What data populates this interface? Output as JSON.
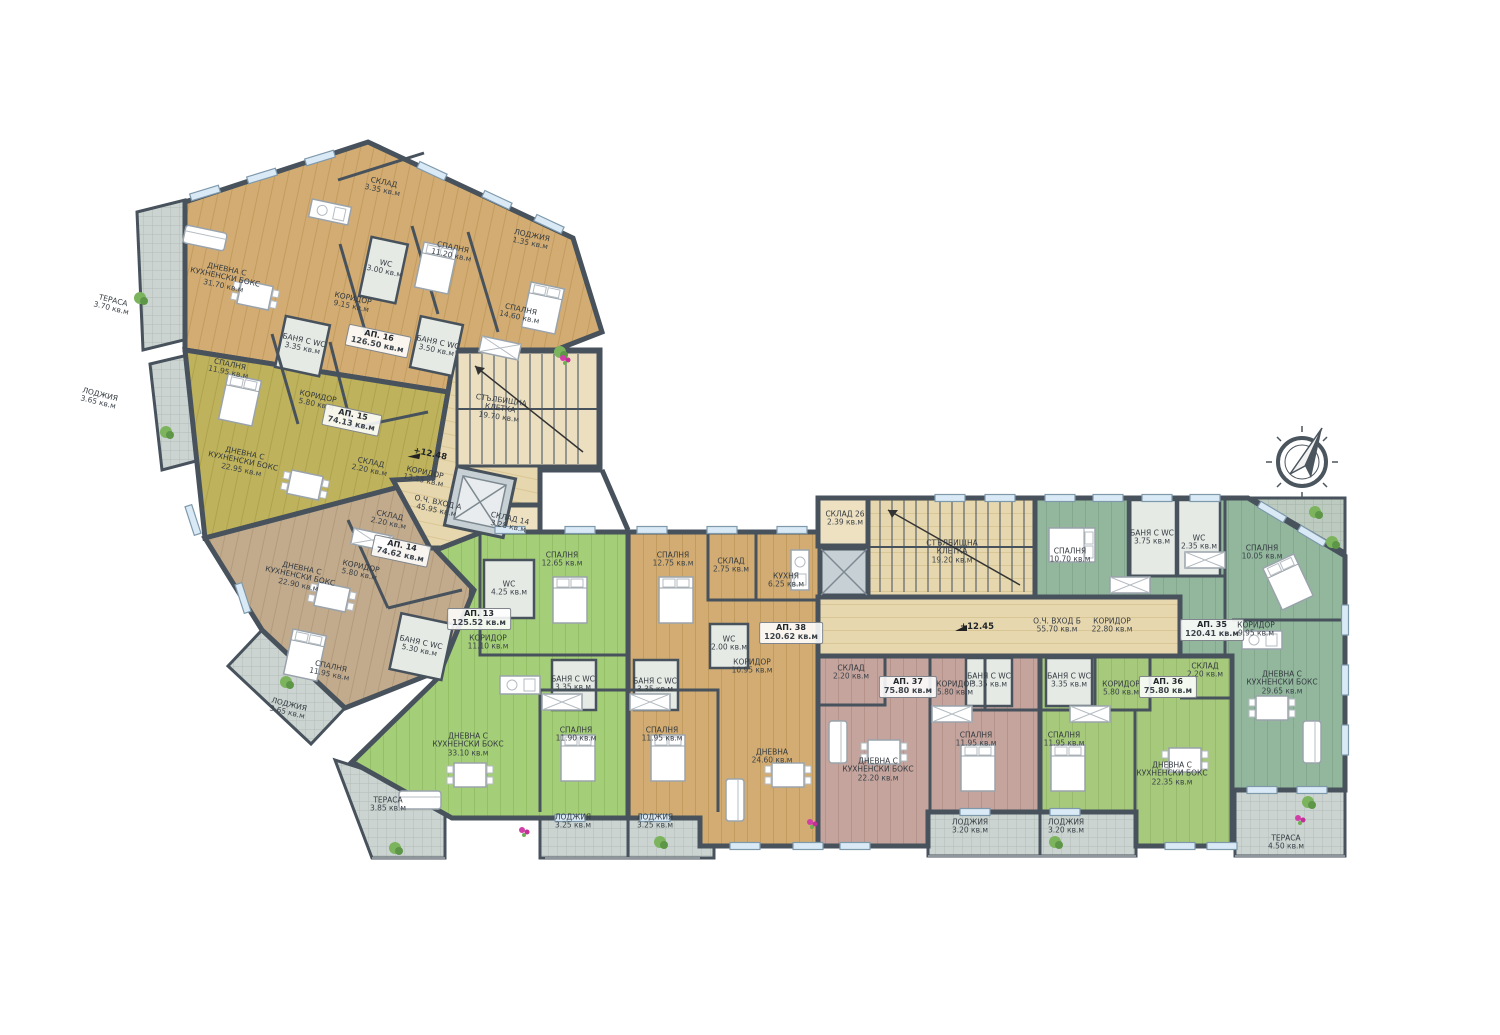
{
  "title": "Апартаментен етаж – разпределение (АП. 13–16, АП. 35–38)",
  "colors": {
    "wall": "#47525c",
    "ap16_tan": "#d2ac72",
    "ap15_olive": "#beb25c",
    "ap14_taupe": "#c2ab8d",
    "ap13_green": "#a4ce77",
    "ap38_tan": "#d2ac72",
    "ap37_pink": "#c4a49c",
    "ap36_green": "#a6c97c",
    "ap35_teal": "#92b79d",
    "common_beige": "#e7d7ae",
    "tiles_gray": "#ccd4d1",
    "window_blue": "#d9e9f5"
  },
  "icons": {
    "compass": "compass-rose-icon",
    "elevator": "elevator-x-icon",
    "stairs": "staircase-icon",
    "elevation_marker": "survey-flag-icon"
  },
  "markers": [
    {
      "t": "+12.48",
      "x": 430,
      "y": 455,
      "r": 12
    },
    {
      "t": "+12.45",
      "x": 977,
      "y": 628,
      "r": 0
    }
  ],
  "rooms": [
    {
      "t": "СКЛАД",
      "a": "3.35 кв.м",
      "x": 383,
      "y": 187,
      "r": 12
    },
    {
      "t": "ДНЕВНА С КУХНЕНСКИ БОКС",
      "a": "31.70 кв.м",
      "x": 225,
      "y": 278,
      "r": 12
    },
    {
      "t": "ТЕРАСА",
      "a": "3.70 кв.м",
      "x": 112,
      "y": 305,
      "r": 14
    },
    {
      "t": "ЛОДЖИЯ",
      "a": "1.35 кв.м",
      "x": 531,
      "y": 240,
      "r": 12
    },
    {
      "t": "СПАЛНЯ",
      "a": "11.20 кв.м",
      "x": 452,
      "y": 252,
      "r": 12
    },
    {
      "t": "WC",
      "a": "3.00 кв.м",
      "x": 385,
      "y": 268,
      "r": 12
    },
    {
      "t": "КОРИДОР",
      "a": "9.15 кв.м",
      "x": 352,
      "y": 303,
      "r": 12
    },
    {
      "t": "СПАЛНЯ",
      "a": "14.60 кв.м",
      "x": 520,
      "y": 314,
      "r": 12
    },
    {
      "t": "АП. 16",
      "a": "126.50 кв.м",
      "x": 378,
      "y": 341,
      "r": 12,
      "b": true
    },
    {
      "t": "БАНЯ С WC",
      "a": "3.50 кв.м",
      "x": 437,
      "y": 347,
      "r": 12
    },
    {
      "t": "БАНЯ С WC",
      "a": "3.35 кв.м",
      "x": 303,
      "y": 345,
      "r": 12
    },
    {
      "t": "СПАЛНЯ",
      "a": "11.95 кв.м",
      "x": 229,
      "y": 369,
      "r": 12
    },
    {
      "t": "ЛОДЖИЯ",
      "a": "3.65 кв.м",
      "x": 99,
      "y": 399,
      "r": 14
    },
    {
      "t": "КОРИДОР",
      "a": "5.80 кв.м",
      "x": 317,
      "y": 401,
      "r": 12
    },
    {
      "t": "АП. 15",
      "a": "74.13 кв.м",
      "x": 352,
      "y": 420,
      "r": 12,
      "b": true
    },
    {
      "t": "СТЪЛБИЩНА КЛЕТКА",
      "a": "19.70 кв.м",
      "x": 500,
      "y": 409,
      "r": 8
    },
    {
      "t": "ДНЕВНА С КУХНЕНСКИ БОКС",
      "a": "22.95 кв.м",
      "x": 243,
      "y": 462,
      "r": 12
    },
    {
      "t": "СКЛАД",
      "a": "2.20 кв.м",
      "x": 370,
      "y": 467,
      "r": 12
    },
    {
      "t": "КОРИДОР",
      "a": "13.25 кв.м",
      "x": 424,
      "y": 477,
      "r": 12
    },
    {
      "t": "О.Ч. ВХОД А",
      "a": "45.95 кв.м",
      "x": 437,
      "y": 507,
      "r": 12
    },
    {
      "t": "СКЛАД 14",
      "a": "3.28 кв.м",
      "x": 509,
      "y": 523,
      "r": 12
    },
    {
      "t": "СКЛАД",
      "a": "2.20 кв.м",
      "x": 389,
      "y": 520,
      "r": 12
    },
    {
      "t": "АП. 14",
      "a": "74.62 кв.м",
      "x": 401,
      "y": 551,
      "r": 12,
      "b": true
    },
    {
      "t": "КОРИДОР",
      "a": "5.80 кв.м",
      "x": 360,
      "y": 571,
      "r": 12
    },
    {
      "t": "ДНЕВНА С КУХНЕНСКИ БОКС",
      "a": "22.90 кв.м",
      "x": 300,
      "y": 577,
      "r": 12
    },
    {
      "t": "WC",
      "a": "4.25 кв.м",
      "x": 509,
      "y": 589,
      "r": 0
    },
    {
      "t": "СПАЛНЯ",
      "a": "12.65 кв.м",
      "x": 562,
      "y": 560,
      "r": 0
    },
    {
      "t": "АП. 13",
      "a": "125.52 кв.м",
      "x": 479,
      "y": 619,
      "r": 0,
      "b": true
    },
    {
      "t": "КОРИДОР",
      "a": "11.10 кв.м",
      "x": 488,
      "y": 643,
      "r": 0
    },
    {
      "t": "БАНЯ С WC",
      "a": "5.30 кв.м",
      "x": 420,
      "y": 647,
      "r": 12
    },
    {
      "t": "СПАЛНЯ",
      "a": "11.95 кв.м",
      "x": 330,
      "y": 671,
      "r": 12
    },
    {
      "t": "ЛОДЖИЯ",
      "a": "3.65 кв.м",
      "x": 288,
      "y": 709,
      "r": 14
    },
    {
      "t": "БАНЯ С WC",
      "a": "3.35 кв.м",
      "x": 573,
      "y": 684,
      "r": 0
    },
    {
      "t": "БАНЯ С WC",
      "a": "3.35 кв.м",
      "x": 655,
      "y": 686,
      "r": 0
    },
    {
      "t": "ДНЕВНА С КУХНЕНСКИ БОКС",
      "a": "33.10 кв.м",
      "x": 468,
      "y": 745,
      "r": 0
    },
    {
      "t": "ТЕРАСА",
      "a": "3.85 кв.м",
      "x": 388,
      "y": 805,
      "r": 0
    },
    {
      "t": "СПАЛНЯ",
      "a": "11.90 кв.м",
      "x": 576,
      "y": 735,
      "r": 0
    },
    {
      "t": "СПАЛНЯ",
      "a": "11.95 кв.м",
      "x": 662,
      "y": 735,
      "r": 0
    },
    {
      "t": "ЛОДЖИЯ",
      "a": "3.25 кв.м",
      "x": 573,
      "y": 822,
      "r": 0
    },
    {
      "t": "ЛОДЖИЯ",
      "a": "3.25 кв.м",
      "x": 655,
      "y": 822,
      "r": 0
    },
    {
      "t": "СПАЛНЯ",
      "a": "12.75 кв.м",
      "x": 673,
      "y": 560,
      "r": 0
    },
    {
      "t": "СКЛАД",
      "a": "2.75 кв.м",
      "x": 731,
      "y": 566,
      "r": 0
    },
    {
      "t": "КУХНЯ",
      "a": "6.25 кв.м",
      "x": 786,
      "y": 581,
      "r": 0
    },
    {
      "t": "WC",
      "a": "2.00 кв.м",
      "x": 729,
      "y": 644,
      "r": 0
    },
    {
      "t": "КОРИДОР",
      "a": "10.95 кв.м",
      "x": 752,
      "y": 667,
      "r": 0
    },
    {
      "t": "АП. 38",
      "a": "120.62 кв.м",
      "x": 791,
      "y": 633,
      "r": 0,
      "b": true
    },
    {
      "t": "ДНЕВНА",
      "a": "24.60 кв.м",
      "x": 772,
      "y": 757,
      "r": 0
    },
    {
      "t": "СКЛАД 26",
      "a": "2.39 кв.м",
      "x": 845,
      "y": 519,
      "r": 0
    },
    {
      "t": "СТЪЛБИЩНА КЛЕТКА",
      "a": "19.20 кв.м",
      "x": 952,
      "y": 552,
      "r": 0
    },
    {
      "t": "О.Ч. ВХОД Б",
      "a": "55.70 кв.м",
      "x": 1057,
      "y": 626,
      "r": 0
    },
    {
      "t": "КОРИДОР",
      "a": "22.80 кв.м",
      "x": 1112,
      "y": 626,
      "r": 0
    },
    {
      "t": "СПАЛНЯ",
      "a": "10.70 кв.м",
      "x": 1070,
      "y": 556,
      "r": 0
    },
    {
      "t": "БАНЯ С WC",
      "a": "3.75 кв.м",
      "x": 1152,
      "y": 538,
      "r": 0
    },
    {
      "t": "WC",
      "a": "2.35 кв.м",
      "x": 1199,
      "y": 543,
      "r": 0
    },
    {
      "t": "СПАЛНЯ",
      "a": "10.05 кв.м",
      "x": 1262,
      "y": 553,
      "r": 0
    },
    {
      "t": "АП. 35",
      "a": "120.41 кв.м",
      "x": 1212,
      "y": 630,
      "r": 0,
      "b": true
    },
    {
      "t": "КОРИДОР",
      "a": "9.95 кв.м",
      "x": 1256,
      "y": 630,
      "r": 0
    },
    {
      "t": "СКЛАД",
      "a": "2.20 кв.м",
      "x": 1205,
      "y": 671,
      "r": 0
    },
    {
      "t": "ДНЕВНА С КУХНЕНСКИ БОКС",
      "a": "29.65 кв.м",
      "x": 1282,
      "y": 683,
      "r": 0
    },
    {
      "t": "СКЛАД",
      "a": "2.20 кв.м",
      "x": 851,
      "y": 673,
      "r": 0
    },
    {
      "t": "АП. 37",
      "a": "75.80 кв.м",
      "x": 908,
      "y": 687,
      "r": 0,
      "b": true
    },
    {
      "t": "КОРИДОР",
      "a": "5.80 кв.м",
      "x": 955,
      "y": 689,
      "r": 0
    },
    {
      "t": "БАНЯ С WC",
      "a": "3.35 кв.м",
      "x": 989,
      "y": 681,
      "r": 0
    },
    {
      "t": "БАНЯ С WC",
      "a": "3.35 кв.м",
      "x": 1069,
      "y": 681,
      "r": 0
    },
    {
      "t": "КОРИДОР",
      "a": "5.80 кв.м",
      "x": 1121,
      "y": 689,
      "r": 0
    },
    {
      "t": "АП. 36",
      "a": "75.80 кв.м",
      "x": 1168,
      "y": 687,
      "r": 0,
      "b": true
    },
    {
      "t": "СПАЛНЯ",
      "a": "11.95 кв.м",
      "x": 976,
      "y": 740,
      "r": 0
    },
    {
      "t": "СПАЛНЯ",
      "a": "11.95 кв.м",
      "x": 1064,
      "y": 740,
      "r": 0
    },
    {
      "t": "ДНЕВНА С КУХНЕНСКИ БОКС",
      "a": "22.20 кв.м",
      "x": 878,
      "y": 770,
      "r": 0
    },
    {
      "t": "ДНЕВНА С КУХНЕНСКИ БОКС",
      "a": "22.35 кв.м",
      "x": 1172,
      "y": 774,
      "r": 0
    },
    {
      "t": "ЛОДЖИЯ",
      "a": "3.20 кв.м",
      "x": 970,
      "y": 827,
      "r": 0
    },
    {
      "t": "ЛОДЖИЯ",
      "a": "3.20 кв.м",
      "x": 1066,
      "y": 827,
      "r": 0
    },
    {
      "t": "ТЕРАСА",
      "a": "4.50 кв.м",
      "x": 1286,
      "y": 843,
      "r": 0
    }
  ]
}
